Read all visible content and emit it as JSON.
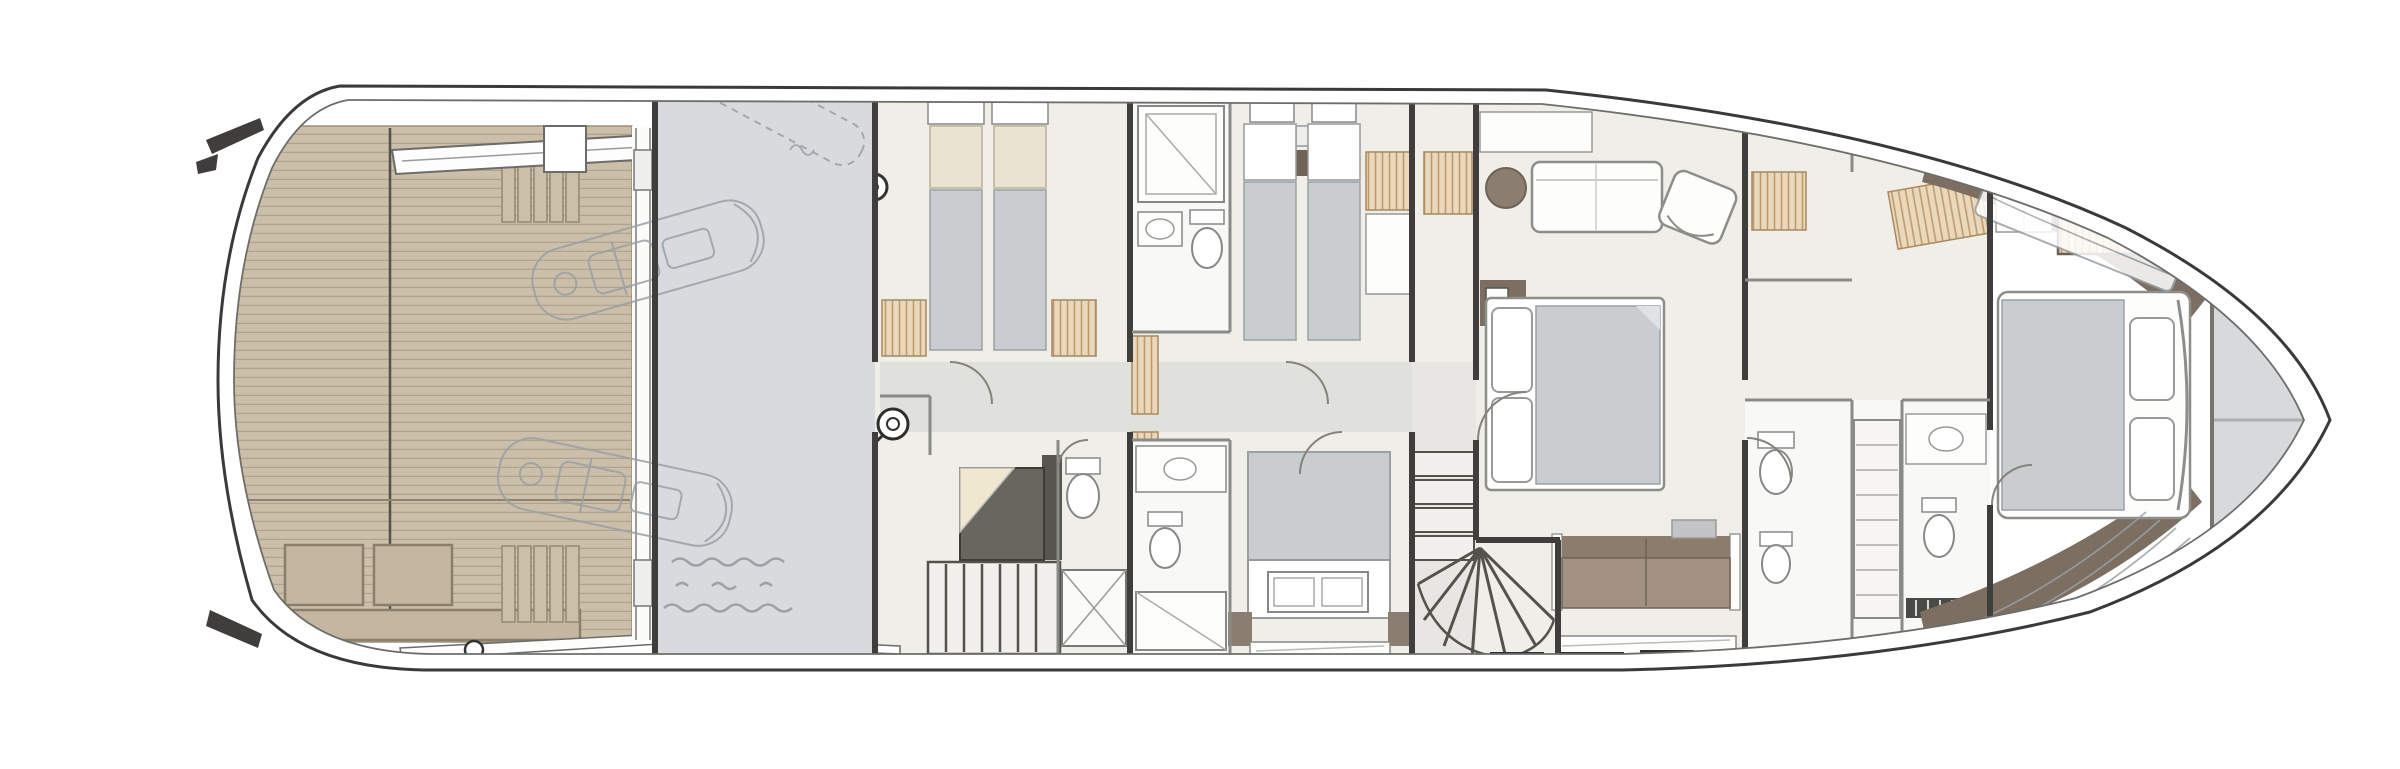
{
  "figure": {
    "subject": "Motor yacht lower deck floor plan, top-down rendered view",
    "orientation": "bow to the right, stern to the left",
    "visible_text": "none (only a faint illegible pencil note near the tender garage)"
  },
  "palette": {
    "hull_stroke": "#3a3a3c",
    "teak": "#cbbfa9",
    "teak_line": "#b2a48c",
    "teak_panel": "#c4b6a0",
    "engine_room": "#d9dadd",
    "floor": "#efeee9",
    "corridor": "#e0e0dc",
    "bathroom": "#f8f8f6",
    "wall": "#3f3e3c",
    "partition": "#8a8a86",
    "bed": "#c9cdd0",
    "pillow_beige": "#e9e3d1",
    "wardrobe": "#ead8bd",
    "wardrobe_line": "#bd9a6c",
    "taupe": "#8b7d6f",
    "taupe_dark": "#6f6356",
    "deck_brown": "#7c6f62",
    "sofa": "#a29180",
    "sofa_back": "#8b7c6c",
    "stair_sofa": "#68675f",
    "pencil": "#99a0a5",
    "foredeck": "#d8d9db",
    "white": "#ffffff"
  },
  "areas": [
    {
      "id": "beach-club",
      "label": "Stern beach club with teak deck and transom stairs"
    },
    {
      "id": "tender-lift",
      "label": "Tender lift tracks"
    },
    {
      "id": "engine-room",
      "label": "Engine room / garage bay (pencil-sketched tenders and davit)"
    },
    {
      "id": "crew-twin-cabin",
      "label": "Aft twin cabin"
    },
    {
      "id": "aft-stair-lobby",
      "label": "Aft stair lobby with sofa, laundry porthole and day head"
    },
    {
      "id": "guest-twin-cabin",
      "label": "Guest twin cabin with en-suite shower room"
    },
    {
      "id": "guest-double-cabin",
      "label": "Guest double cabin with en-suite and foot bench"
    },
    {
      "id": "midship-staircase",
      "label": "Curved fan staircase to main deck"
    },
    {
      "id": "master-stateroom",
      "label": "Full-beam master stateroom with bed, chaise, vanity and sofa"
    },
    {
      "id": "forward-bathrooms",
      "label": "Forward his-and-hers bathrooms with shelving column"
    },
    {
      "id": "bow-vip-cabin",
      "label": "Forward VIP cabin with offset double bed and wardrobe"
    },
    {
      "id": "foredeck-locker",
      "label": "Bow locker deck at the stem"
    }
  ],
  "annotations": {
    "engine_room_note": "faint illegible handwritten pencil note (three short lines)",
    "sketch_overlays": "watercraft, davit arm, bow sunpad and bow steps drawn in light pencil"
  }
}
